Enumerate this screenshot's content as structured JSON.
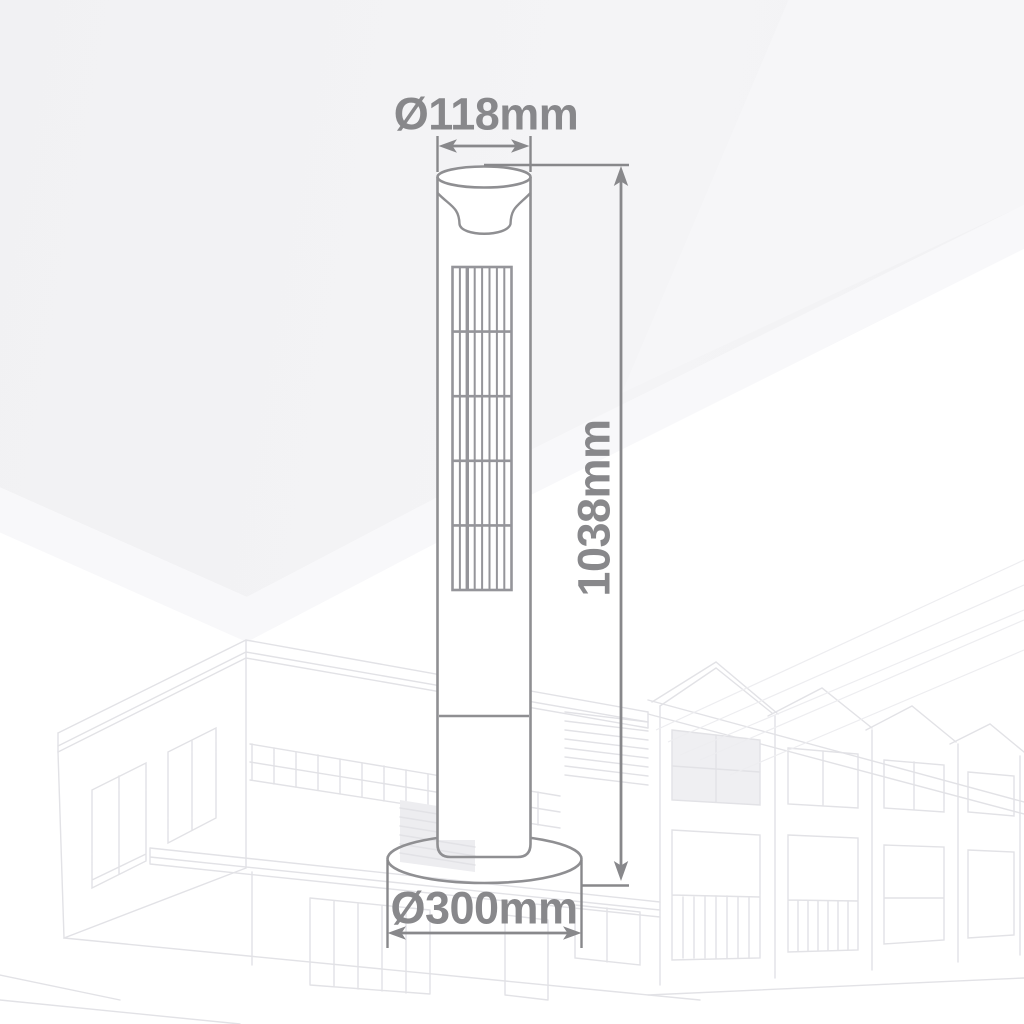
{
  "diagram": {
    "product": "tower-fan-dimension-drawing",
    "dimensions": {
      "top_diameter": "Ø118mm",
      "height": "1038mm",
      "base_diameter": "Ø300mm"
    },
    "colors": {
      "dimension_text": "#88888b",
      "dimension_line": "#88888b",
      "fan_outline": "#8f8f92",
      "background_top": "#f2f2f3",
      "watermark_line": "#e2e2e6"
    }
  }
}
